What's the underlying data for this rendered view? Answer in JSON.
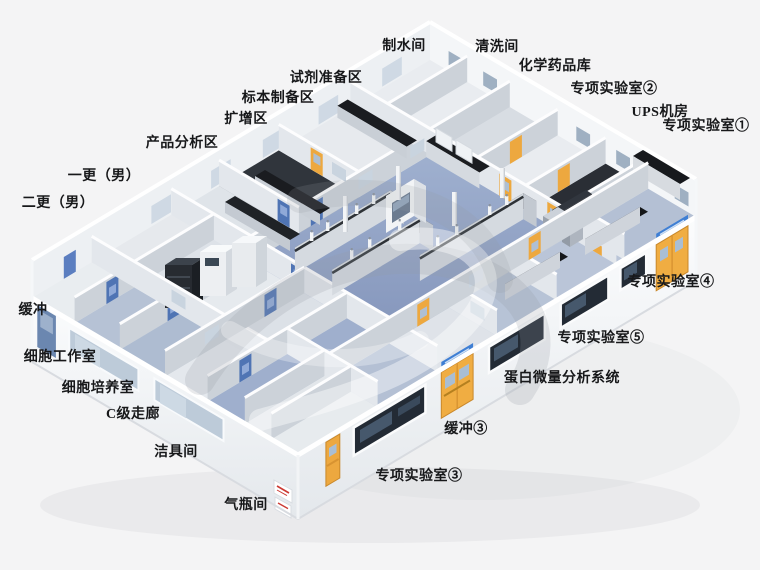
{
  "scene": {
    "type": "isometric-laboratory-floorplan-render",
    "background": "#f4f4f5"
  },
  "palette": {
    "wall_white": "#f6f8fa",
    "wall_shadow": "#cdd3d9",
    "floor_blue": "#8e9fc2",
    "floor_light": "#e7eaee",
    "floor_dark": "#30353c",
    "bench_dark": "#191b1f",
    "bench_base": "#d5dae0",
    "door_yellow": "#eda83f",
    "door_blue": "#4f74b4",
    "window_dark": "#232b35",
    "window_light": "#bdcbd9",
    "header_sign_blue": "#3f7fd4",
    "poster_red": "#cc3a33",
    "label_text": "#17181a"
  },
  "labels": [
    {
      "id": "water-production-room",
      "text": "制水间"
    },
    {
      "id": "washing-room",
      "text": "清洗间"
    },
    {
      "id": "chemical-storage",
      "text": "化学药品库"
    },
    {
      "id": "special-lab-2",
      "text": "专项实验室②"
    },
    {
      "id": "ups-room",
      "text": "UPS机房"
    },
    {
      "id": "special-lab-1",
      "text": "专项实验室①"
    },
    {
      "id": "reagent-prep-area",
      "text": "试剂准备区"
    },
    {
      "id": "specimen-prep-area",
      "text": "标本制备区"
    },
    {
      "id": "amplification-area",
      "text": "扩增区"
    },
    {
      "id": "product-analysis-area",
      "text": "产品分析区"
    },
    {
      "id": "first-change-male",
      "text": "一更（男）"
    },
    {
      "id": "second-change-male",
      "text": "二更（男）"
    },
    {
      "id": "buffer",
      "text": "缓冲"
    },
    {
      "id": "cell-workroom",
      "text": "细胞工作室"
    },
    {
      "id": "cell-culture-room",
      "text": "细胞培养室"
    },
    {
      "id": "c-grade-corridor",
      "text": "C级走廊"
    },
    {
      "id": "cleaning-tools-room",
      "text": "洁具间"
    },
    {
      "id": "gas-cylinder-room",
      "text": "气瓶间"
    },
    {
      "id": "special-lab-4",
      "text": "专项实验室④"
    },
    {
      "id": "special-lab-5",
      "text": "专项实验室⑤"
    },
    {
      "id": "protein-microanalysis-system",
      "text": "蛋白微量分析系统"
    },
    {
      "id": "buffer-3",
      "text": "缓冲③"
    },
    {
      "id": "special-lab-3",
      "text": "专项实验室③"
    }
  ]
}
